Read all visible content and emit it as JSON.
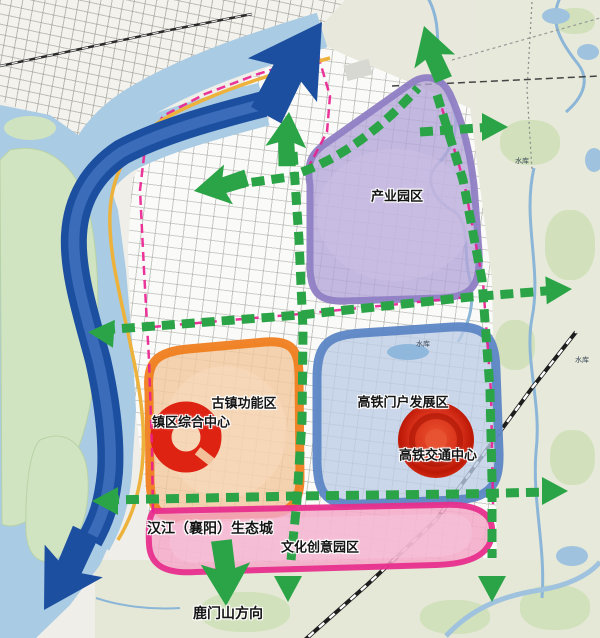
{
  "map": {
    "zones": {
      "industrial": {
        "label": "产业园区",
        "fill": "#b4a5d7",
        "border": "#8f7ec4"
      },
      "hsr_gateway": {
        "label": "高铁门户发展区",
        "fill": "#bccde5",
        "border": "#5c86c5"
      },
      "ancient_town": {
        "label": "古镇功能区",
        "fill": "#f4c89c",
        "border": "#f07e20"
      },
      "cultural_park": {
        "label": "文化创意园区",
        "fill": "#f3a8c8",
        "border": "#e72f8d"
      },
      "eco_city": {
        "label": "汉江（襄阳）生态城",
        "border": "#e72f8d"
      }
    },
    "centers": {
      "town_center": {
        "label": "镇区综合中心",
        "color": "#d62b12"
      },
      "hsr_hub": {
        "label": "高铁交通中心",
        "color": "#d62b12"
      }
    },
    "direction": {
      "lumen": {
        "label": "鹿门山方向"
      }
    },
    "water_labels": {
      "a": "水库",
      "b": "水库",
      "c": "水库"
    },
    "colors": {
      "axis_green": "#2ba447",
      "river_arrow_blue": "#1c4f9f",
      "boundary_magenta": "#ea1f8f",
      "waterfront_yellow": "#edb23c",
      "water_blue": "#a9cbe3"
    }
  }
}
